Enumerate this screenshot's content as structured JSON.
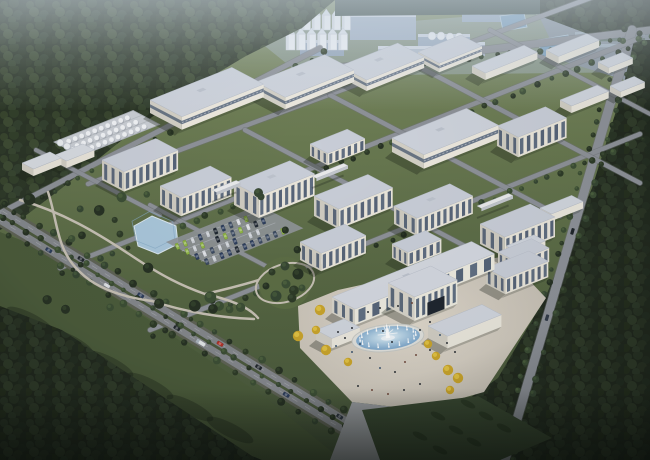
{
  "scene": {
    "description": "Aerial rendering of an industrial park campus at dusk",
    "width": 650,
    "height": 460,
    "palette": {
      "grass_top": "#7e8c66",
      "grass_mid": "#697951",
      "grass_low": "#556542",
      "grass_dark": "#45543a",
      "forest_base": "#222a1f",
      "forest_light": "#2e3a2a",
      "meadow": "#4b5b3b",
      "road": "#84878c",
      "road_dark": "#6f7277",
      "road_verge": "#5f6356",
      "roof": "#cdd2db",
      "wall_lit": "#ebe7dd",
      "wall_shade": "#d2cfc5",
      "glass": "#50607a",
      "band": "#5a6a80",
      "plaza_center": "#ded7cb",
      "plaza_edge": "#c2bcb1",
      "water_light": "#e8f2f8",
      "water_deep": "#739fc6",
      "pond": "#a9c6da",
      "distant_pond": "#7fa3c0",
      "yellow_tree": "#c9a42c",
      "yellow_tree_light": "#e6c84a",
      "haze": "#d6e2ee",
      "distant_block": "#a3b1c2",
      "car_green": "#8fb545",
      "car_navy": "#2e3f5e",
      "car_red": "#b23228",
      "car_white": "#d8dbe0",
      "car_black": "#22282e"
    },
    "axes": {
      "ux": 0.93,
      "uy": -0.37,
      "vx": 0.885,
      "vy": 0.465
    },
    "forests": {
      "top_left": "0,0 335,0 302,28 246,56 182,94 122,140 62,188 20,220 0,230",
      "top_treeline": "335,0 545,0 545,14 335,16",
      "top_right": "540,0 650,0 650,28 588,34 540,16",
      "right": "650,40 650,460 348,460 428,428 498,378 545,298 592,188 622,92 634,40",
      "bottom_left": "0,306 62,330 162,396 252,456 262,460 0,460",
      "meadow": "0,232 36,246 146,318 266,398 342,460 250,460 150,392 40,326 0,306"
    },
    "distant": {
      "wash": "250,34 650,2 650,72 302,76",
      "pad": "540,18 650,8 650,88 560,60",
      "blocks": [
        {
          "x": 350,
          "y": 14,
          "w": 66,
          "h": 26,
          "c": "#a5b4c6"
        },
        {
          "x": 300,
          "y": 40,
          "w": 44,
          "h": 16,
          "c": "#97a8bc"
        },
        {
          "x": 418,
          "y": 34,
          "w": 52,
          "h": 16,
          "c": "#9fafc2"
        },
        {
          "x": 462,
          "y": 6,
          "w": 56,
          "h": 16,
          "c": "#9aacc0"
        },
        {
          "x": 524,
          "y": 2,
          "w": 60,
          "h": 12,
          "c": "#8fa2b6"
        },
        {
          "x": 378,
          "y": 46,
          "w": 54,
          "h": 20,
          "c": "#b4bfcd"
        },
        {
          "x": 445,
          "y": 42,
          "w": 40,
          "h": 14,
          "c": "#aab7c7"
        }
      ],
      "greenhouses": [
        {
          "x": 575,
          "y": 14,
          "w": 70,
          "rows": 6,
          "step": 6
        },
        {
          "x": 480,
          "y": 2,
          "w": 56,
          "rows": 3,
          "step": 5
        }
      ],
      "ponds": [
        "500,16 524,13 527,27 503,31",
        "538,40 568,35 572,52 542,57"
      ],
      "silos": [
        {
          "x": 282,
          "yb": 30,
          "n": 7,
          "step": 10,
          "w": 8.5,
          "h": 15,
          "cone": 6
        },
        {
          "x": 286,
          "yb": 50,
          "n": 6,
          "step": 10.5,
          "w": 9,
          "h": 16,
          "cone": 6
        }
      ],
      "domes": [
        [
          432,
          36
        ],
        [
          441,
          36
        ],
        [
          450,
          37
        ],
        [
          459,
          37
        ]
      ]
    },
    "main_road": {
      "x1": 0,
      "y1": 215,
      "x2": 402,
      "y2": 460,
      "lane_offset": 4.6
    },
    "roads": [
      {
        "n": "edge-road",
        "x1": 0,
        "y1": 213,
        "x2": 320,
        "y2": 48,
        "w": 5,
        "trees": 1
      },
      {
        "n": "top-road",
        "x1": 300,
        "y1": 72,
        "x2": 650,
        "y2": 30,
        "w": 7,
        "trees": 1
      },
      {
        "n": "right-road",
        "x1": 632,
        "y1": 30,
        "x2": 505,
        "y2": 460,
        "w": 9,
        "trees": 2
      },
      {
        "n": "row-road-1",
        "x1": 88,
        "y1": 184,
        "x2": 620,
        "y2": -13,
        "w": 4.5,
        "trees": 0
      },
      {
        "n": "row-road-2",
        "x1": 60,
        "y1": 268,
        "x2": 640,
        "y2": 38,
        "w": 4.5,
        "trees": 1
      },
      {
        "n": "row-road-3",
        "x1": 150,
        "y1": 330,
        "x2": 640,
        "y2": 134,
        "w": 4.5,
        "trees": 1
      },
      {
        "n": "cross-road-1",
        "x1": 245,
        "y1": 130,
        "x2": 480,
        "y2": 254,
        "w": 4.5,
        "trees": 0
      },
      {
        "n": "cross-road-2",
        "x1": 330,
        "y1": 95,
        "x2": 560,
        "y2": 216,
        "w": 4.5,
        "trees": 0
      },
      {
        "n": "cross-road-3",
        "x1": 410,
        "y1": 62,
        "x2": 640,
        "y2": 183,
        "w": 4.5,
        "trees": 0
      },
      {
        "n": "cross-road-4",
        "x1": 150,
        "y1": 205,
        "x2": 300,
        "y2": 284,
        "w": 4,
        "trees": 0
      },
      {
        "n": "cross-road-5",
        "x1": 490,
        "y1": 30,
        "x2": 650,
        "y2": 114,
        "w": 4,
        "trees": 0
      },
      {
        "n": "cross-road-6",
        "x1": 36,
        "y1": 150,
        "x2": 160,
        "y2": 215,
        "w": 4,
        "trees": 0
      }
    ],
    "park": {
      "paths": [
        "M20,200 C62,212 96,232 132,256 C162,276 182,286 205,294",
        "M48,192 C58,222 56,250 80,272 C96,288 122,297 152,301",
        "M205,294 C232,300 250,308 258,318",
        "M152,301 C185,312 222,318 254,319",
        "M205,294 C240,286 268,278 288,270"
      ],
      "pond": "134,226 152,216 176,226 178,244 158,254 138,246",
      "garden": {
        "cx": 285,
        "cy": 283,
        "r": 26
      },
      "conifers": [
        [
          272,
          272
        ],
        [
          285,
          266
        ],
        [
          298,
          274
        ],
        [
          302,
          288
        ],
        [
          292,
          298
        ],
        [
          276,
          296
        ],
        [
          266,
          286
        ],
        [
          286,
          284
        ]
      ],
      "tree_count": 26
    },
    "parking": {
      "origin": [
        172,
        246
      ],
      "rows": 4,
      "cols": 11,
      "row_step": 11,
      "col_step": 8.2,
      "car_colors": [
        "#8fb545",
        "#2e3f5e",
        "#242c36",
        "#d8dbe0",
        "#9fb346",
        "#1f2731",
        "#c7ccd2",
        "#3d4c63",
        "#8fb545",
        "#2e3f5e"
      ]
    },
    "tank_farm": {
      "x": 54,
      "y": 142,
      "l": 85,
      "w": 30,
      "rows": 3,
      "cols": 10,
      "big_tanks": 4
    },
    "buildings": [
      {
        "n": "warehouse-1",
        "x": 150,
        "y": 100,
        "l": 88,
        "w": 36,
        "h": 13,
        "t": "wh"
      },
      {
        "n": "warehouse-2",
        "x": 256,
        "y": 82,
        "l": 74,
        "w": 33,
        "h": 12,
        "t": "wh"
      },
      {
        "n": "warehouse-3",
        "x": 340,
        "y": 66,
        "l": 62,
        "w": 30,
        "h": 11,
        "t": "wh"
      },
      {
        "n": "warehouse-4",
        "x": 418,
        "y": 52,
        "l": 46,
        "w": 24,
        "h": 9,
        "t": "wh"
      },
      {
        "n": "low-block-1",
        "x": 472,
        "y": 66,
        "l": 56,
        "w": 15,
        "h": 7,
        "t": "low"
      },
      {
        "n": "low-block-2",
        "x": 546,
        "y": 50,
        "l": 44,
        "w": 14,
        "h": 7,
        "t": "low"
      },
      {
        "n": "low-block-3",
        "x": 598,
        "y": 62,
        "l": 26,
        "w": 12,
        "h": 6,
        "t": "low"
      },
      {
        "n": "low-block-4",
        "x": 610,
        "y": 86,
        "l": 26,
        "w": 12,
        "h": 6,
        "t": "low"
      },
      {
        "n": "shed-1",
        "x": 22,
        "y": 163,
        "l": 30,
        "w": 13,
        "h": 7,
        "t": "shed"
      },
      {
        "n": "shed-2",
        "x": 55,
        "y": 155,
        "l": 30,
        "w": 13,
        "h": 7,
        "t": "shed"
      },
      {
        "n": "office-a",
        "x": 102,
        "y": 160,
        "l": 58,
        "w": 25,
        "h": 20,
        "t": "of"
      },
      {
        "n": "office-a2",
        "x": 160,
        "y": 186,
        "l": 54,
        "w": 24,
        "h": 19,
        "t": "of"
      },
      {
        "n": "office-b",
        "x": 234,
        "y": 183,
        "l": 60,
        "w": 28,
        "h": 22,
        "t": "of"
      },
      {
        "n": "office-small",
        "x": 310,
        "y": 144,
        "l": 40,
        "w": 20,
        "h": 12,
        "t": "of"
      },
      {
        "n": "warehouse-big",
        "x": 392,
        "y": 138,
        "l": 80,
        "w": 36,
        "h": 14,
        "t": "wh"
      },
      {
        "n": "office-g",
        "x": 497,
        "y": 126,
        "l": 52,
        "w": 24,
        "h": 20,
        "t": "of"
      },
      {
        "n": "low-block-5",
        "x": 560,
        "y": 100,
        "l": 40,
        "w": 13,
        "h": 7,
        "t": "low"
      },
      {
        "n": "office-c",
        "x": 314,
        "y": 196,
        "l": 58,
        "w": 28,
        "h": 20,
        "t": "of"
      },
      {
        "n": "office-e",
        "x": 394,
        "y": 206,
        "l": 60,
        "w": 26,
        "h": 18,
        "t": "of"
      },
      {
        "n": "office-e-front",
        "x": 392,
        "y": 244,
        "l": 36,
        "w": 18,
        "h": 14,
        "t": "of"
      },
      {
        "n": "office-f",
        "x": 300,
        "y": 242,
        "l": 48,
        "w": 24,
        "h": 18,
        "t": "of"
      },
      {
        "n": "office-h",
        "x": 480,
        "y": 224,
        "l": 54,
        "w": 28,
        "h": 20,
        "t": "of"
      },
      {
        "n": "office-h-wing",
        "x": 498,
        "y": 252,
        "l": 36,
        "w": 20,
        "h": 14,
        "t": "of"
      },
      {
        "n": "office-i",
        "x": 486,
        "y": 268,
        "l": 46,
        "w": 22,
        "h": 16,
        "t": "of"
      },
      {
        "n": "low-block-6",
        "x": 540,
        "y": 208,
        "l": 34,
        "w": 13,
        "h": 7,
        "t": "low"
      },
      {
        "n": "low-block-7",
        "x": 506,
        "y": 246,
        "l": 30,
        "w": 13,
        "h": 6,
        "t": "low"
      },
      {
        "n": "gate-annex-left",
        "x": 316,
        "y": 330,
        "l": 30,
        "w": 18,
        "h": 10,
        "t": "low"
      },
      {
        "n": "gate-main-bar",
        "x": 332,
        "y": 297,
        "l": 150,
        "w": 26,
        "h": 16,
        "t": "gate"
      },
      {
        "n": "gate-annex-right",
        "x": 428,
        "y": 326,
        "l": 58,
        "w": 22,
        "h": 12,
        "t": "low"
      },
      {
        "n": "gate-tower",
        "x": 388,
        "y": 283,
        "l": 46,
        "w": 30,
        "h": 24,
        "t": "gate",
        "z": 12
      }
    ],
    "bridges": [
      {
        "x": 212,
        "y": 190,
        "l": 26
      },
      {
        "x": 312,
        "y": 176,
        "l": 34
      },
      {
        "x": 477,
        "y": 206,
        "l": 34
      }
    ],
    "plaza": {
      "poly": "298,306 338,290 420,272 506,256 546,298 484,392 420,410 352,402 300,348",
      "drive": "352,402 420,410 394,460 330,460",
      "lawn_dark": "362,410 478,396 552,438 500,460 380,460",
      "hedges": [
        [
          468,
          404
        ],
        [
          486,
          416
        ],
        [
          504,
          428
        ],
        [
          438,
          416
        ],
        [
          456,
          430
        ],
        [
          474,
          442
        ],
        [
          420,
          436
        ],
        [
          440,
          450
        ]
      ]
    },
    "fountain": {
      "cx": 388,
      "cy": 338,
      "rx": 36,
      "ry": 13.5,
      "jets": 16
    },
    "yellow_trees": [
      [
        320,
        310
      ],
      [
        316,
        330
      ],
      [
        326,
        350
      ],
      [
        348,
        362
      ],
      [
        298,
        336
      ],
      [
        436,
        356
      ],
      [
        448,
        370
      ],
      [
        428,
        344
      ],
      [
        458,
        378
      ],
      [
        450,
        390
      ]
    ],
    "people": [
      [
        352,
        352
      ],
      [
        360,
        344
      ],
      [
        370,
        358
      ],
      [
        380,
        368
      ],
      [
        395,
        372
      ],
      [
        405,
        362
      ],
      [
        416,
        355
      ],
      [
        430,
        350
      ],
      [
        352,
        328
      ],
      [
        345,
        338
      ],
      [
        420,
        330
      ],
      [
        430,
        322
      ],
      [
        440,
        335
      ],
      [
        368,
        312
      ],
      [
        380,
        308
      ],
      [
        398,
        306
      ],
      [
        412,
        303
      ],
      [
        358,
        386
      ],
      [
        372,
        390
      ],
      [
        388,
        394
      ],
      [
        404,
        390
      ],
      [
        420,
        384
      ],
      [
        338,
        332
      ],
      [
        336,
        346
      ],
      [
        447,
        343
      ],
      [
        455,
        352
      ],
      [
        392,
        342
      ],
      [
        383,
        331
      ]
    ],
    "vehicles_main_road": [
      {
        "d": 60,
        "l": 1,
        "c": "#2e3f5e"
      },
      {
        "d": 92,
        "l": -1,
        "c": "#22282e"
      },
      {
        "d": 128,
        "l": 1,
        "c": "#d8dbe0"
      },
      {
        "d": 162,
        "l": -1,
        "c": "#2e3f5e"
      },
      {
        "d": 210,
        "l": 1,
        "c": "#22282e"
      },
      {
        "d": 238,
        "l": 1,
        "c": "#e2e5e8",
        "truck": 1
      },
      {
        "d": 255,
        "l": -1,
        "c": "#b23228"
      },
      {
        "d": 300,
        "l": -1,
        "c": "#22282e"
      },
      {
        "d": 338,
        "l": 1,
        "c": "#2e3f5e"
      },
      {
        "d": 395,
        "l": -1,
        "c": "#2c3440"
      }
    ],
    "vehicles_right_road": [
      {
        "d": 210,
        "c": "#20262c"
      },
      {
        "d": 300,
        "c": "#333c4a"
      }
    ]
  }
}
